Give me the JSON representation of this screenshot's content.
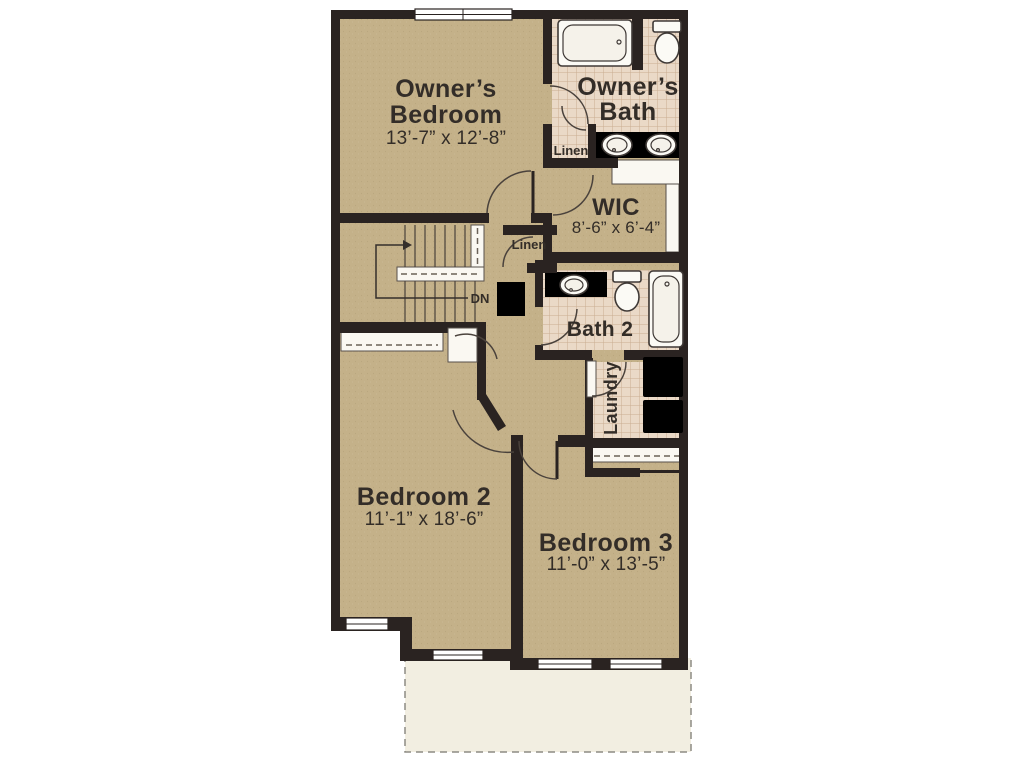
{
  "watermark": {
    "brand": "bright",
    "trademark": "™",
    "suffix": "MLS"
  },
  "plan": {
    "owners_bedroom": {
      "label_line1": "Owner’s",
      "label_line2": "Bedroom",
      "dimensions": "13’-7” x 12’-8”"
    },
    "owners_bath": {
      "label_line1": "Owner’s",
      "label_line2": "Bath"
    },
    "linen_owners": {
      "label": "Linen"
    },
    "wic": {
      "label": "WIC",
      "dimensions": "8’-6” x 6’-4”"
    },
    "linen_hall": {
      "label": "Linen"
    },
    "stairs": {
      "direction_label": "DN"
    },
    "bath_2": {
      "label": "Bath 2"
    },
    "laundry": {
      "label": "Laundry"
    },
    "bedroom_2": {
      "label": "Bedroom 2",
      "dimensions": "11’-1” x 18’-6”"
    },
    "bedroom_3": {
      "label": "Bedroom 3",
      "dimensions": "11’-0” x 13’-5”"
    }
  },
  "colors": {
    "wall": "#2a2321",
    "floor_tan": "#c4b189",
    "tile": "#ead9c7",
    "tile_grid": "#c9ad92",
    "fixture_outline": "#3f3936",
    "cream_area": "#f2eee1",
    "counter": "#d9d2c9",
    "watermark_bg": "#696969",
    "watermark_text": "#f2f1ee",
    "watermark_accent": "#c7572a",
    "label_text": "#332d28"
  }
}
